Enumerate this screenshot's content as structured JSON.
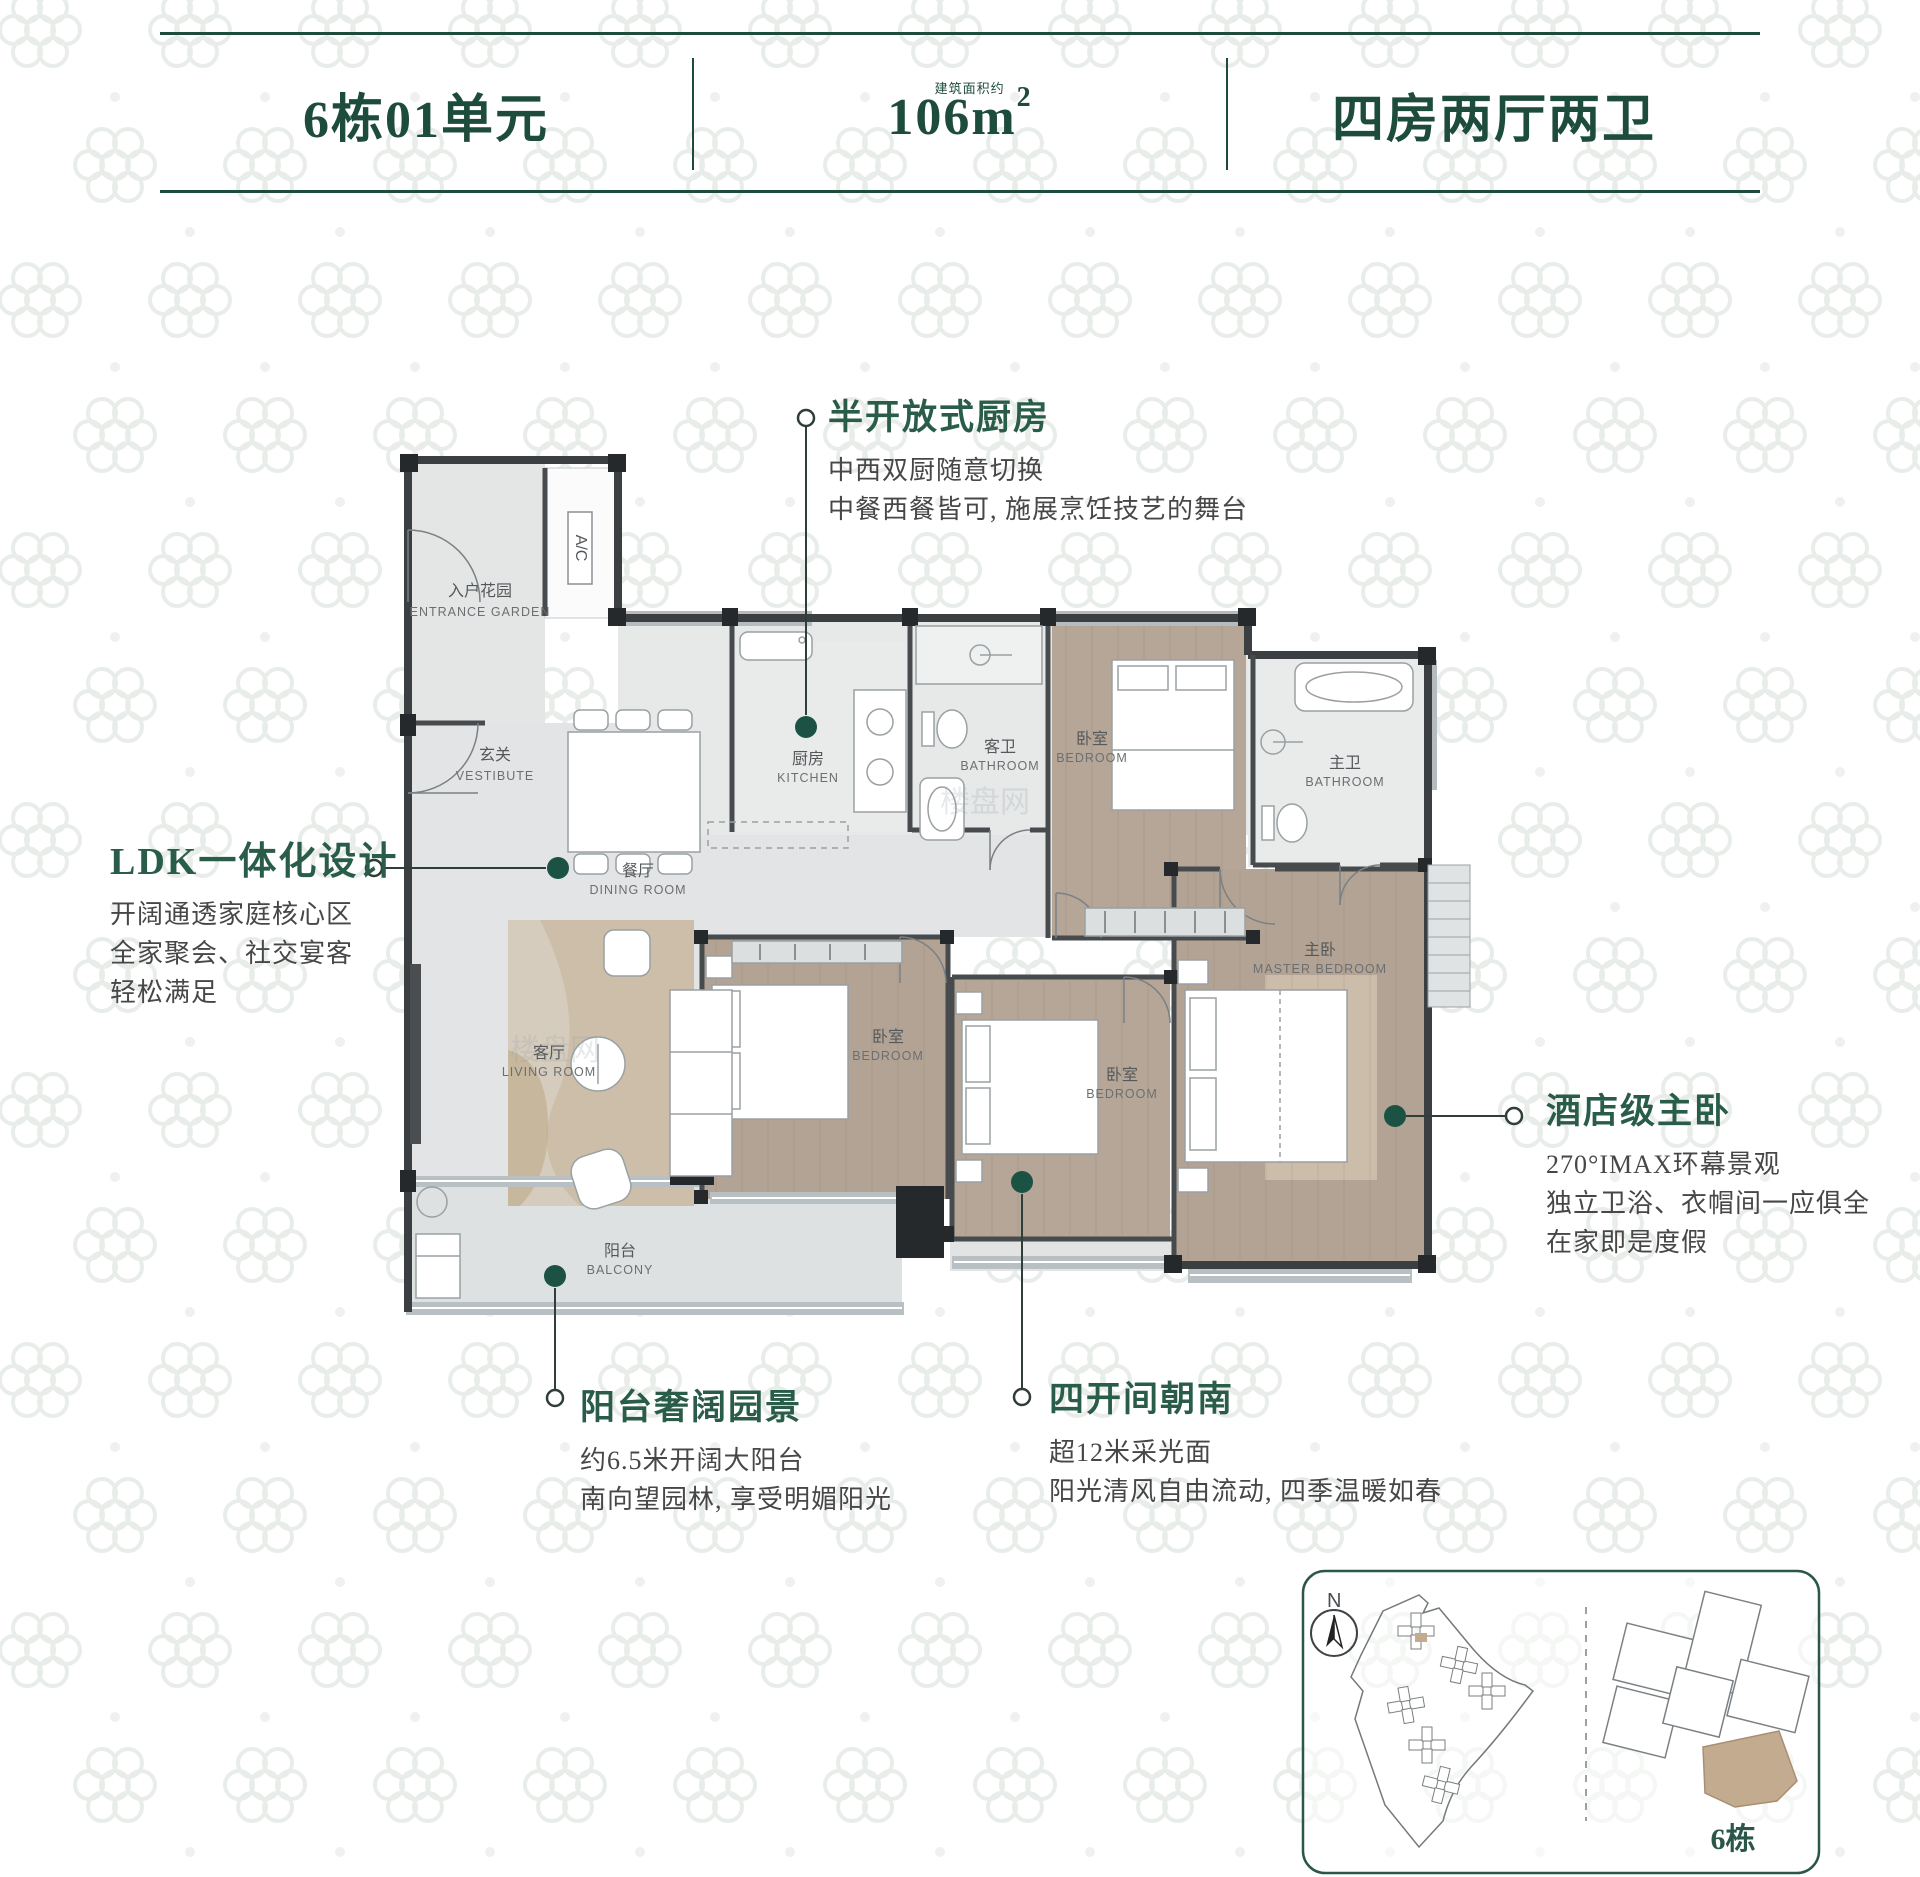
{
  "header": {
    "unit": "6栋01单元",
    "area_value": "106m",
    "area_sup": "2",
    "area_note": "建筑面积约",
    "layout": "四房两厅两卫"
  },
  "callouts": {
    "kitchen": {
      "title": "半开放式厨房",
      "lines": [
        "中西双厨随意切换",
        "中餐西餐皆可, 施展烹饪技艺的舞台"
      ]
    },
    "ldk": {
      "title": "LDK一体化设计",
      "lines": [
        "开阔通透家庭核心区",
        "全家聚会、社交宴客",
        "轻松满足"
      ]
    },
    "master": {
      "title": "酒店级主卧",
      "lines": [
        "270°IMAX环幕景观",
        "独立卫浴、衣帽间一应俱全",
        "在家即是度假"
      ]
    },
    "balcony": {
      "title": "阳台奢阔园景",
      "lines": [
        "约6.5米开阔大阳台",
        "南向望园林, 享受明媚阳光"
      ]
    },
    "south": {
      "title": "四开间朝南",
      "lines": [
        "超12米采光面",
        "阳光清风自由流动, 四季温暖如春"
      ]
    }
  },
  "rooms": {
    "entrance_garden": {
      "zh": "入户花园",
      "en": "ENTRANCE GARDEN"
    },
    "vestibule": {
      "zh": "玄关",
      "en": "VESTIBUTE"
    },
    "dining": {
      "zh": "餐厅",
      "en": "DINING ROOM"
    },
    "living": {
      "zh": "客厅",
      "en": "LIVING ROOM"
    },
    "kitchen": {
      "zh": "厨房",
      "en": "KITCHEN"
    },
    "guest_bath": {
      "zh": "客卫",
      "en": "BATHROOM"
    },
    "master_bath": {
      "zh": "主卫",
      "en": "BATHROOM"
    },
    "bedroom_top": {
      "zh": "卧室",
      "en": "BEDROOM"
    },
    "bedroom_mid": {
      "zh": "卧室",
      "en": "BEDROOM"
    },
    "bedroom_south": {
      "zh": "卧室",
      "en": "BEDROOM"
    },
    "master_bedroom": {
      "zh": "主卧",
      "en": "MASTER BEDROOM"
    },
    "balcony": {
      "zh": "阳台",
      "en": "BALCONY"
    },
    "ac": "A/C"
  },
  "siteplan": {
    "north_label": "N",
    "building_label": "6栋"
  },
  "watermark": "楼盘网",
  "colors": {
    "brand_green": "#1d4b3c",
    "callout_green": "#2a5c4a",
    "dot_green": "#1c5244",
    "wood": "#b6a697",
    "marble": "#e3e4e5",
    "wall": "#3b3f42",
    "window_gray": "#b5bcc0",
    "highlight_tan": "#c3ab90"
  }
}
